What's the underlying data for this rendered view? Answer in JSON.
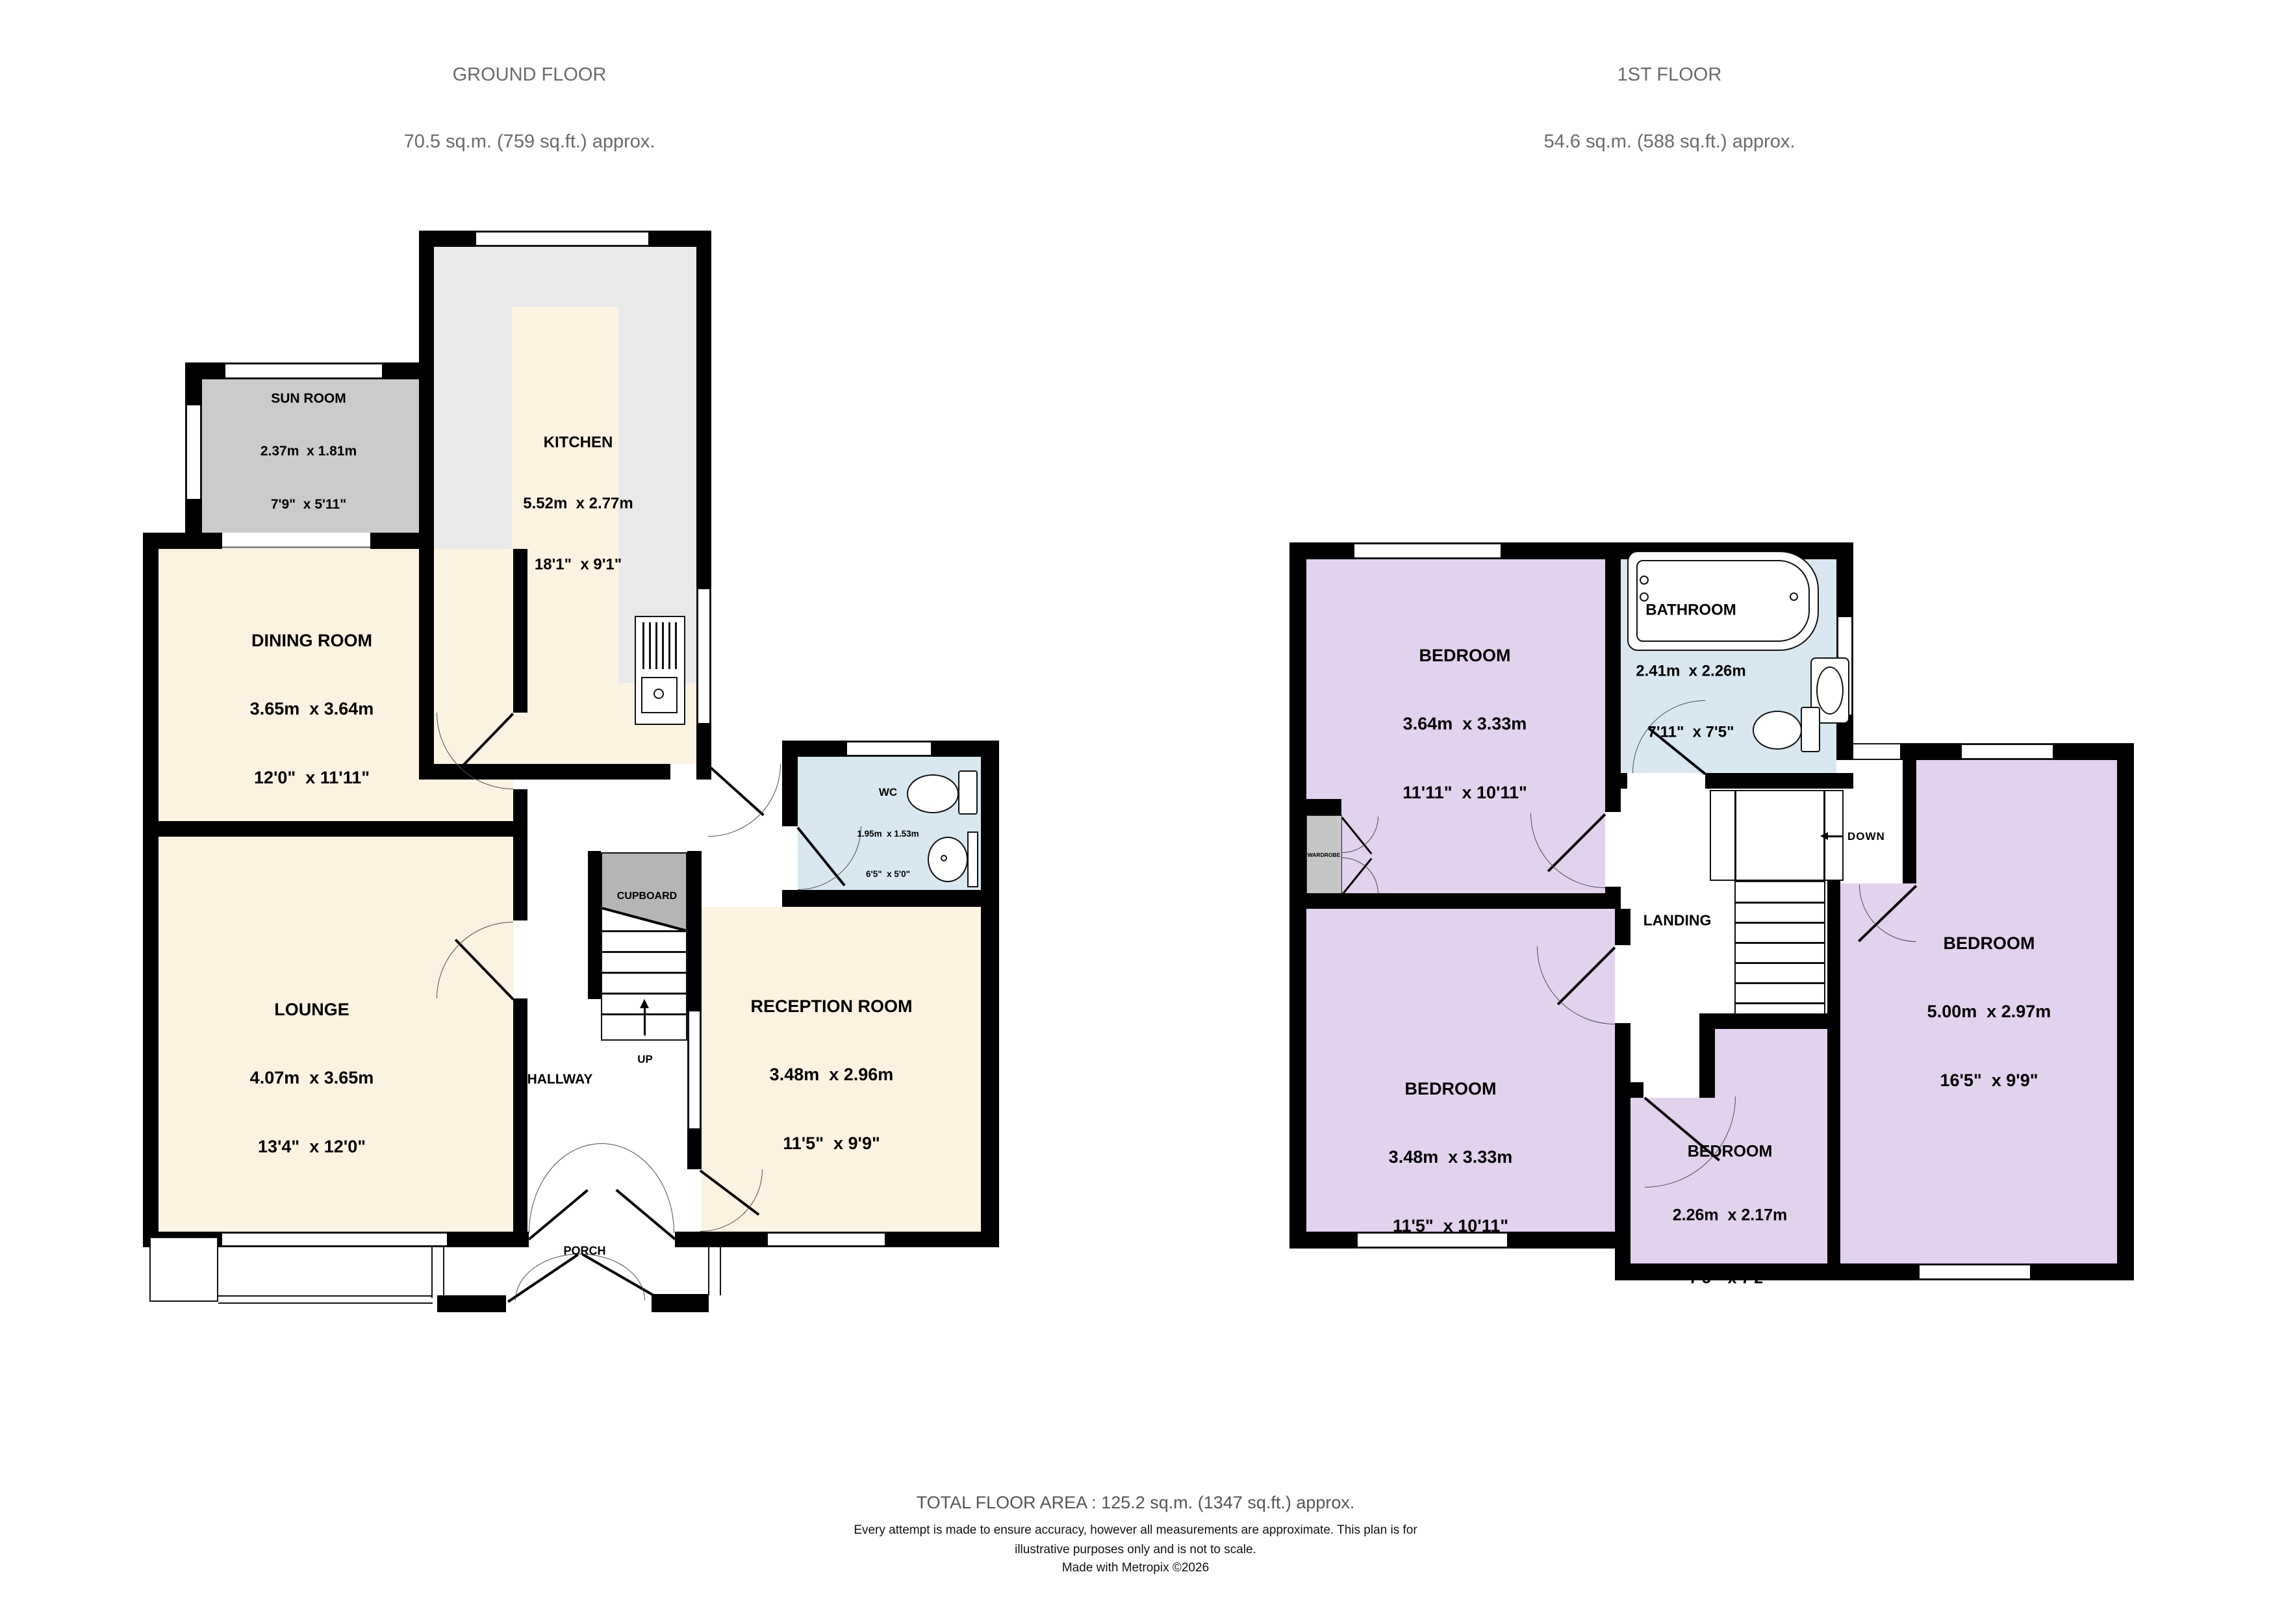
{
  "ground_floor": {
    "title": "GROUND FLOOR",
    "area": "70.5 sq.m. (759 sq.ft.) approx.",
    "rooms": {
      "sun_room": {
        "name": "SUN ROOM",
        "metric": "2.37m  x 1.81m",
        "imperial": "7'9\"  x 5'11\""
      },
      "kitchen": {
        "name": "KITCHEN",
        "metric": "5.52m  x 2.77m",
        "imperial": "18'1\"  x 9'1\""
      },
      "dining_room": {
        "name": "DINING ROOM",
        "metric": "3.65m  x 3.64m",
        "imperial": "12'0\"  x 11'11\""
      },
      "lounge": {
        "name": "LOUNGE",
        "metric": "4.07m  x 3.65m",
        "imperial": "13'4\"  x 12'0\""
      },
      "wc": {
        "name": "WC",
        "metric": "1.95m  x 1.53m",
        "imperial": "6'5\"  x 5'0\""
      },
      "reception_room": {
        "name": "RECEPTION ROOM",
        "metric": "3.48m  x 2.96m",
        "imperial": "11'5\"  x 9'9\""
      }
    },
    "labels": {
      "hallway": "HALLWAY",
      "cupboard": "CUPBOARD",
      "up": "UP",
      "porch": "PORCH"
    }
  },
  "first_floor": {
    "title": "1ST FLOOR",
    "area": "54.6 sq.m. (588 sq.ft.) approx.",
    "rooms": {
      "bedroom_1": {
        "name": "BEDROOM",
        "metric": "3.64m  x 3.33m",
        "imperial": "11'11\"  x 10'11\""
      },
      "bathroom": {
        "name": "BATHROOM",
        "metric": "2.41m  x 2.26m",
        "imperial": "7'11\"  x 7'5\""
      },
      "bedroom_2": {
        "name": "BEDROOM",
        "metric": "3.48m  x 3.33m",
        "imperial": "11'5\"  x 10'11\""
      },
      "bedroom_3": {
        "name": "BEDROOM",
        "metric": "2.26m  x 2.17m",
        "imperial": "7'5\"  x 7'2\""
      },
      "bedroom_4": {
        "name": "BEDROOM",
        "metric": "5.00m  x 2.97m",
        "imperial": "16'5\"  x 9'9\""
      }
    },
    "labels": {
      "landing": "LANDING",
      "down": "DOWN",
      "wardrobe": "WARDROBE"
    }
  },
  "footer": {
    "total": "TOTAL FLOOR AREA : 125.2 sq.m. (1347 sq.ft.) approx.",
    "disclaimer_1": "Every attempt is made to ensure accuracy, however all measurements are approximate. This plan is for",
    "disclaimer_2": "illustrative purposes only and is not to scale.",
    "credit": "Made with Metropix ©2026"
  },
  "colors": {
    "cream_room": "#fcf2e2",
    "purple_room": "#e2d2ee",
    "blue_room": "#d9e7f0",
    "sunroom_gray": "#cbcbcb",
    "counter_gray": "#e9e9e9",
    "cupboard_gray": "#b5b5b5",
    "wall_black": "#000000",
    "title_gray": "#6a6a6a"
  }
}
